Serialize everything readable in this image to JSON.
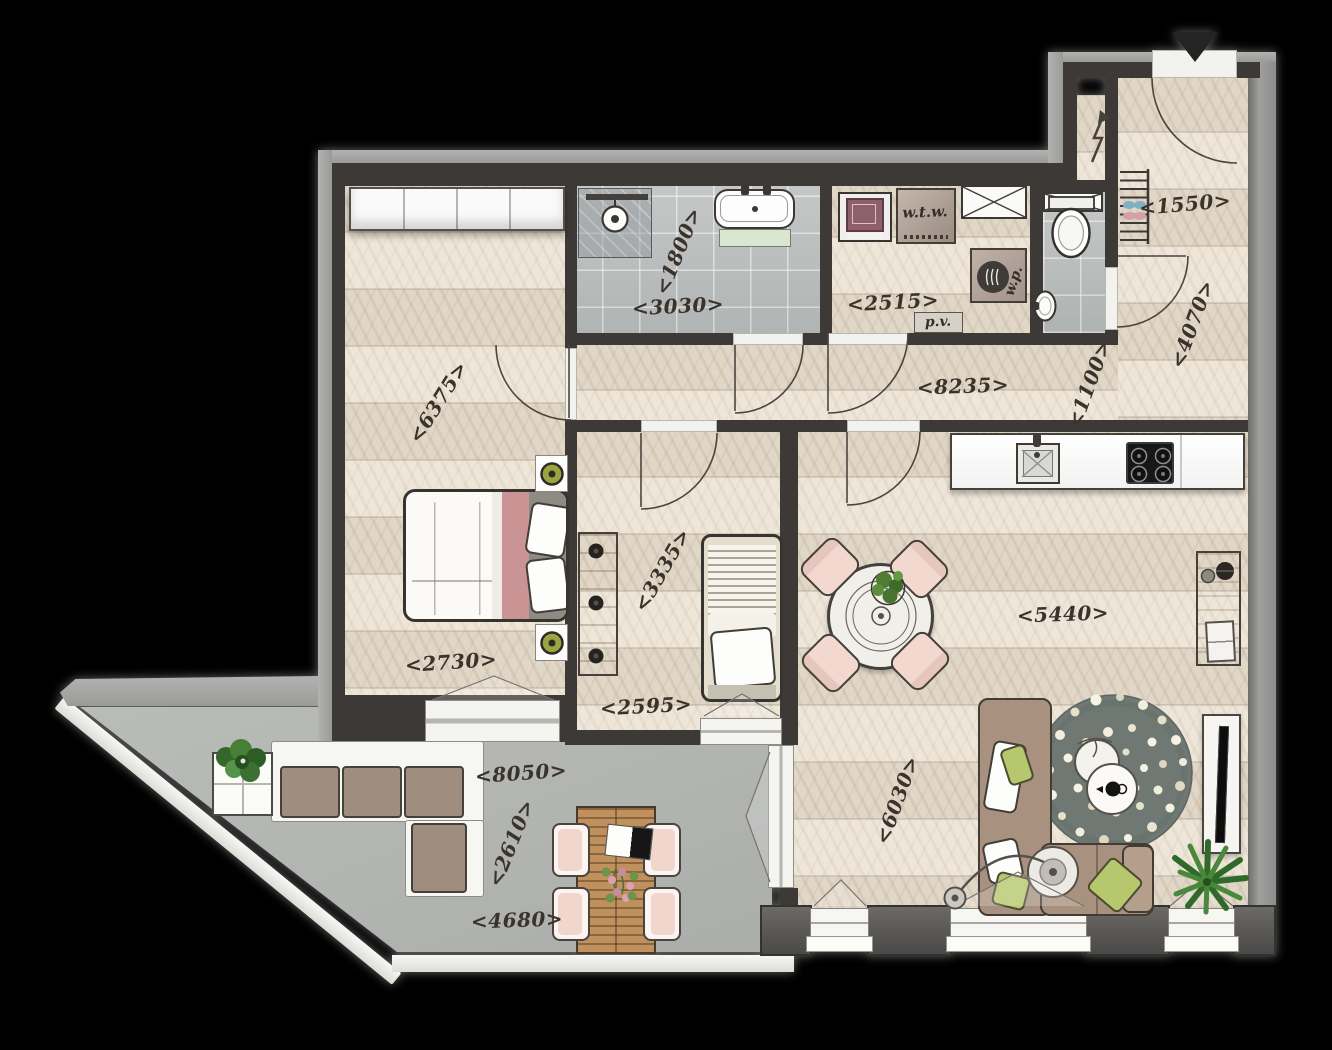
{
  "title": "apartment-floor-plan",
  "palette": {
    "bg": "#000000",
    "wood": "#e8dfd0",
    "tile": "#b9bcbc",
    "wall-dark": "#3d3936",
    "wall-outer": "#9a9a98",
    "concrete": "#b2b4b1",
    "slab": "#dddcd6",
    "ink": "#3a332c",
    "pink": "#f2d8cf",
    "blanket-pink": "#cb9494",
    "olive": "#9aa441",
    "sofa-taupe": "#a8927f",
    "rug-green": "#6f7873",
    "plant-green": "#3f7a31",
    "furniture-wood": "#bb8a55",
    "machine-maroon": "#8f5f6b",
    "vanity-green": "#d9e6d0"
  },
  "dimension_labels": [
    {
      "id": "6375",
      "text": "<6375>",
      "x": 438,
      "y": 402,
      "rotate": -58
    },
    {
      "id": "1800",
      "text": "<1800>",
      "x": 678,
      "y": 251,
      "rotate": -68
    },
    {
      "id": "3030",
      "text": "<3030>",
      "x": 678,
      "y": 306,
      "rotate": -3
    },
    {
      "id": "2515",
      "text": "<2515>",
      "x": 893,
      "y": 302,
      "rotate": -3
    },
    {
      "id": "1550",
      "text": "<1550>",
      "x": 1185,
      "y": 204,
      "rotate": -5
    },
    {
      "id": "4070",
      "text": "<4070>",
      "x": 1192,
      "y": 324,
      "rotate": -70
    },
    {
      "id": "1100",
      "text": "<1100>",
      "x": 1089,
      "y": 384,
      "rotate": -70
    },
    {
      "id": "8235",
      "text": "<8235>",
      "x": 963,
      "y": 386,
      "rotate": -2
    },
    {
      "id": "3335",
      "text": "<3335>",
      "x": 662,
      "y": 570,
      "rotate": -60
    },
    {
      "id": "2730",
      "text": "<2730>",
      "x": 451,
      "y": 662,
      "rotate": -4
    },
    {
      "id": "2595",
      "text": "<2595>",
      "x": 646,
      "y": 706,
      "rotate": -3
    },
    {
      "id": "5440",
      "text": "<5440>",
      "x": 1063,
      "y": 614,
      "rotate": -2
    },
    {
      "id": "8050",
      "text": "<8050>",
      "x": 521,
      "y": 773,
      "rotate": -4
    },
    {
      "id": "2610",
      "text": "<2610>",
      "x": 511,
      "y": 843,
      "rotate": -68
    },
    {
      "id": "6030",
      "text": "<6030>",
      "x": 897,
      "y": 800,
      "rotate": -70
    },
    {
      "id": "4680",
      "text": "<4680>",
      "x": 517,
      "y": 920,
      "rotate": -2
    }
  ],
  "equipment_labels": [
    {
      "id": "wtw",
      "text": "w.t.w.",
      "x": 925,
      "y": 212,
      "rotate": -2,
      "size": 15
    },
    {
      "id": "wp",
      "text": "w.p.",
      "x": 1014,
      "y": 281,
      "rotate": -72,
      "size": 14
    },
    {
      "id": "pv",
      "text": "p.v.",
      "x": 938,
      "y": 322,
      "rotate": -2,
      "size": 14
    }
  ],
  "icons": [
    {
      "name": "entrance-arrow-icon"
    },
    {
      "name": "lightning-icon"
    },
    {
      "name": "shaft-cross-icon"
    },
    {
      "name": "door-swing-arc-icon"
    },
    {
      "name": "window-opening-triangle-icon"
    }
  ]
}
